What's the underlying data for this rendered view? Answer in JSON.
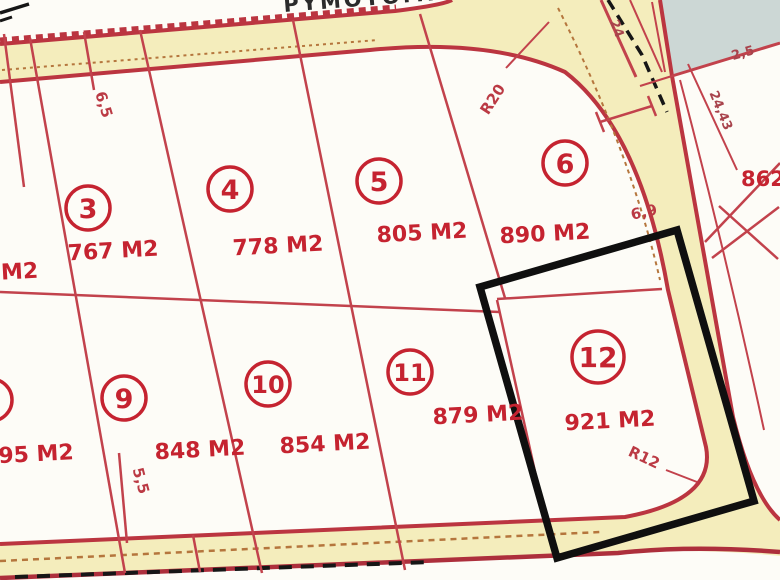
{
  "map_title": "Cadastral parcel plan",
  "street": {
    "name": "ΡΥΜΟΤΟΜΙΑ"
  },
  "plots": {
    "p2": {
      "area": "M2"
    },
    "p3": {
      "number": "3",
      "area": "767 M2"
    },
    "p4": {
      "number": "4",
      "area": "778 M2"
    },
    "p5": {
      "number": "5",
      "area": "805 M2"
    },
    "p6": {
      "number": "6",
      "area": "890 M2"
    },
    "p8": {
      "area": "895 M2"
    },
    "p9": {
      "number": "9",
      "area": "848 M2"
    },
    "p10": {
      "number": "10",
      "area": "854 M2"
    },
    "p11": {
      "number": "11",
      "area": "879 M2"
    },
    "p12": {
      "number": "12",
      "area": "921 M2",
      "highlighted": true
    },
    "p862": {
      "area": "862"
    }
  },
  "dimensions": {
    "r20": "R20",
    "r12": "R12",
    "w65": "6,5",
    "w55": "5,5",
    "w25": "2,5",
    "l2443": "24,43",
    "l24": "24",
    "l69": "6,9"
  },
  "colors": {
    "parcel_line": "#c2424c",
    "road_edge": "#bb3540",
    "road_fill": "#f4edbc",
    "area_text": "#c52330",
    "street_text": "#2b2b2b",
    "highlight_box": "#0f0f0f",
    "offmap_zone": "#ccd7d5",
    "tan_dash": "#b5763d",
    "background": "#fdfcf7"
  }
}
